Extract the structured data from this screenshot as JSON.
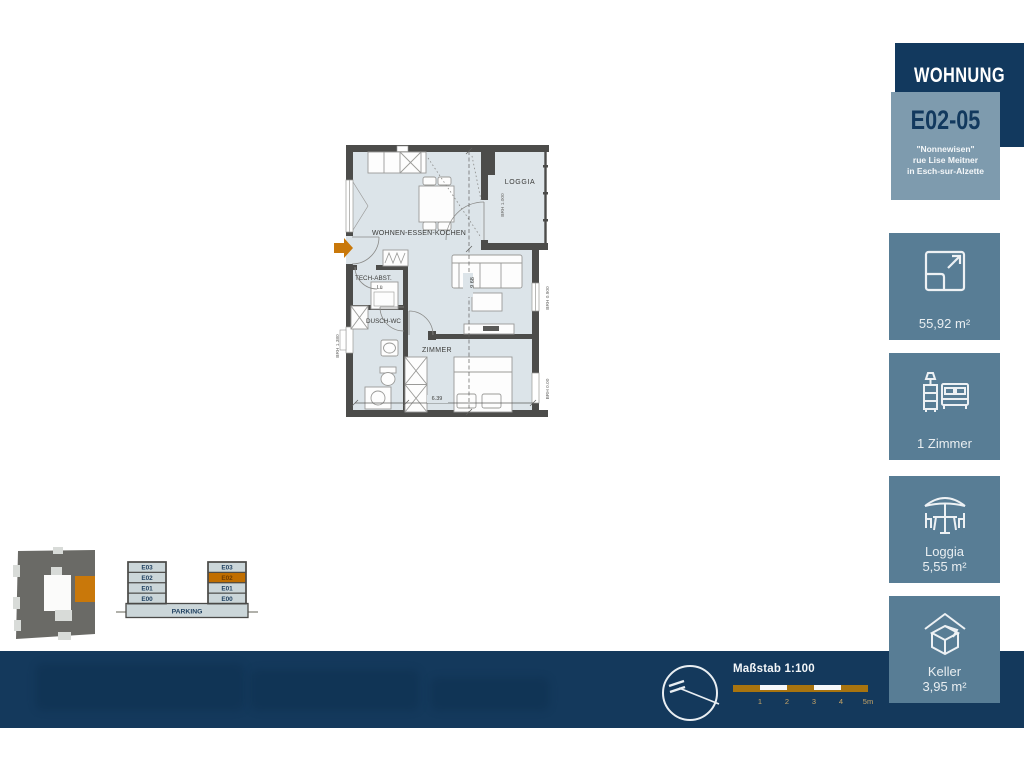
{
  "header": {
    "title": "WOHNUNG",
    "unit": "E02-05",
    "address_line1": "\"Nonnewisen\"",
    "address_line2": "rue Lise Meitner",
    "address_line3": "in Esch-sur-Alzette"
  },
  "cards": [
    {
      "icon": "area-expand-icon",
      "label": "55,92 m²"
    },
    {
      "icon": "bedroom-icon",
      "label": "1 Zimmer"
    },
    {
      "icon": "loggia-parasol-icon",
      "label": "Loggia",
      "sublabel": "5,55 m²"
    },
    {
      "icon": "keller-box-icon",
      "label": "Keller",
      "sublabel": "3,95 m²"
    }
  ],
  "floorplan": {
    "rooms": {
      "living": "WOHNEN-ESSEN-KOCHEN",
      "loggia": "LOGGIA",
      "tech": "TECH-ABST.",
      "bath": "DUSCH-WC",
      "bedroom": "ZIMMER",
      "vent": "Lü"
    },
    "dimensions": {
      "height": "9.68",
      "width": "6.39"
    },
    "brh": {
      "loggia": "BRH 1.000",
      "left": "BRH 1.380",
      "right_upper": "BRH 0.900",
      "right_lower": "BRH 0.00"
    }
  },
  "section_diagram": {
    "floors": [
      "E03",
      "E02",
      "E01",
      "E00"
    ],
    "highlighted_floor": "E02",
    "parking": "PARKING"
  },
  "footer": {
    "scale_label": "Maßstab 1:100",
    "scale_ticks": [
      "1",
      "2",
      "3",
      "4",
      "5m"
    ]
  },
  "colors": {
    "navy": "#12395E",
    "slate_card": "#587D95",
    "light_slate": "#7E9BAE",
    "orange": "#C9780A",
    "gold": "#A8740F"
  }
}
